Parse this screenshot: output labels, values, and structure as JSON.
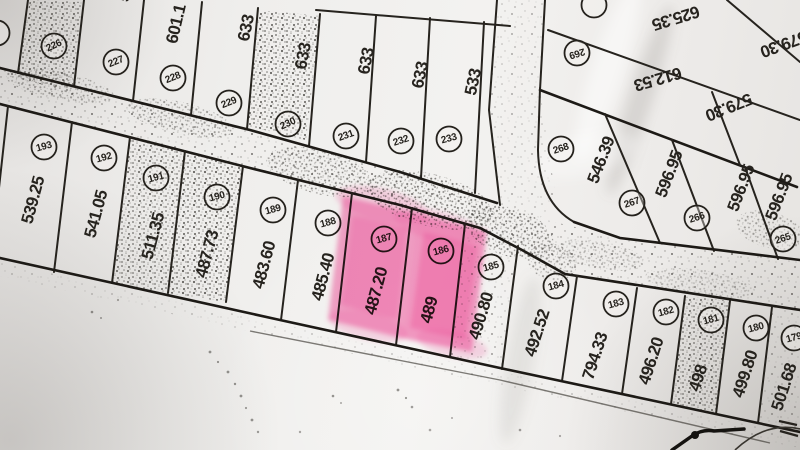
{
  "colors": {
    "highlight": "#f6509e",
    "highlight_soft": "#fa8ec2",
    "ink": "#26231e",
    "paper": "#efedea"
  },
  "map": {
    "highlighted_parcel_ids": [
      "187",
      "186"
    ],
    "parcels": [
      {
        "id": "",
        "area": "",
        "cx": -3,
        "cy": 33,
        "crot": -20
      },
      {
        "id": "226",
        "area": "",
        "cx": 54,
        "cy": 46,
        "crot": -25,
        "shaded": true
      },
      {
        "id": "227",
        "area": "5",
        "cx": 116,
        "cy": 62,
        "crot": -22,
        "ax": 124,
        "ay": -3,
        "arot": -78
      },
      {
        "id": "228",
        "area": "601.1",
        "cx": 173,
        "cy": 78,
        "crot": -22,
        "ax": 176,
        "ay": 24,
        "arot": -77
      },
      {
        "id": "229",
        "area": "633",
        "cx": 229,
        "cy": 103,
        "crot": -22,
        "ax": 246,
        "ay": 28,
        "arot": -78
      },
      {
        "id": "230",
        "area": "633",
        "cx": 288,
        "cy": 124,
        "crot": -25,
        "ax": 303,
        "ay": 56,
        "arot": -79,
        "shaded": true
      },
      {
        "id": "231",
        "area": "633",
        "cx": 346,
        "cy": 136,
        "crot": -20,
        "ax": 366,
        "ay": 61,
        "arot": -79
      },
      {
        "id": "232",
        "area": "633",
        "cx": 401,
        "cy": 141,
        "crot": -18,
        "ax": 420,
        "ay": 75,
        "arot": -78
      },
      {
        "id": "233",
        "area": "533",
        "cx": 449,
        "cy": 139,
        "crot": -15,
        "ax": 473,
        "ay": 82,
        "arot": -78
      },
      {
        "id": "",
        "area": "625.35",
        "cx": 594,
        "cy": 5,
        "crot": 163,
        "ax": 676,
        "ay": 18,
        "arot": 163
      },
      {
        "id": "269",
        "area": "612.53",
        "cx": 577,
        "cy": 53,
        "crot": 163,
        "ax": 658,
        "ay": 79,
        "arot": 164
      },
      {
        "id": "",
        "area": "579.30",
        "ax": 784,
        "ay": 44,
        "arot": 160
      },
      {
        "id": "",
        "area": "579.30",
        "ax": 729,
        "ay": 107,
        "arot": 158
      },
      {
        "id": "268",
        "area": "546.39",
        "cx": 561,
        "cy": 149,
        "crot": -18,
        "ax": 601,
        "ay": 160,
        "arot": -69
      },
      {
        "id": "267",
        "area": "596.95",
        "cx": 632,
        "cy": 203,
        "crot": -18,
        "ax": 669,
        "ay": 174,
        "arot": -69
      },
      {
        "id": "266",
        "area": "596.95",
        "cx": 697,
        "cy": 218,
        "crot": -18,
        "ax": 741,
        "ay": 188,
        "arot": -69
      },
      {
        "id": "265",
        "area": "596.95",
        "cx": 783,
        "cy": 239,
        "crot": -18,
        "ax": 779,
        "ay": 197,
        "arot": -69
      },
      {
        "id": "193",
        "area": "539.25",
        "cx": 44,
        "cy": 147,
        "crot": -15,
        "ax": 33,
        "ay": 200,
        "arot": -75
      },
      {
        "id": "192",
        "area": "541.05",
        "cx": 104,
        "cy": 158,
        "crot": -15,
        "ax": 96,
        "ay": 214,
        "arot": -75
      },
      {
        "id": "191",
        "area": "511.35",
        "cx": 156,
        "cy": 178,
        "crot": -15,
        "ax": 153,
        "ay": 236,
        "arot": -75,
        "shaded": true
      },
      {
        "id": "190",
        "area": "487.73",
        "cx": 217,
        "cy": 197,
        "crot": -15,
        "ax": 207,
        "ay": 254,
        "arot": -75,
        "shaded": true
      },
      {
        "id": "189",
        "area": "483.60",
        "cx": 273,
        "cy": 210,
        "crot": -15,
        "ax": 264,
        "ay": 265,
        "arot": -75
      },
      {
        "id": "188",
        "area": "485.40",
        "cx": 328,
        "cy": 223,
        "crot": -15,
        "ax": 323,
        "ay": 277,
        "arot": -75
      },
      {
        "id": "187",
        "area": "487.20",
        "cx": 384,
        "cy": 239,
        "crot": -15,
        "ax": 376,
        "ay": 291,
        "arot": -75,
        "highlighted": true
      },
      {
        "id": "186",
        "area": "489",
        "cx": 441,
        "cy": 251,
        "crot": -15,
        "ax": 429,
        "ay": 310,
        "arot": -75,
        "highlighted": true
      },
      {
        "id": "185",
        "area": "490.80",
        "cx": 491,
        "cy": 267,
        "crot": -15,
        "ax": 481,
        "ay": 316,
        "arot": -73
      },
      {
        "id": "184",
        "area": "492.52",
        "cx": 556,
        "cy": 286,
        "crot": -15,
        "ax": 537,
        "ay": 333,
        "arot": -72
      },
      {
        "id": "183",
        "area": "794.33",
        "cx": 616,
        "cy": 304,
        "crot": -15,
        "ax": 595,
        "ay": 356,
        "arot": -72
      },
      {
        "id": "182",
        "area": "496.20",
        "cx": 666,
        "cy": 312,
        "crot": -15,
        "ax": 651,
        "ay": 361,
        "arot": -72
      },
      {
        "id": "181",
        "area": "498",
        "cx": 711,
        "cy": 320,
        "crot": -15,
        "ax": 698,
        "ay": 378,
        "arot": -72,
        "shaded": true
      },
      {
        "id": "180",
        "area": "499.80",
        "cx": 756,
        "cy": 328,
        "crot": -15,
        "ax": 745,
        "ay": 374,
        "arot": -72
      },
      {
        "id": "179",
        "area": "501.68",
        "cx": 794,
        "cy": 338,
        "crot": -15,
        "ax": 784,
        "ay": 387,
        "arot": -72
      }
    ]
  }
}
